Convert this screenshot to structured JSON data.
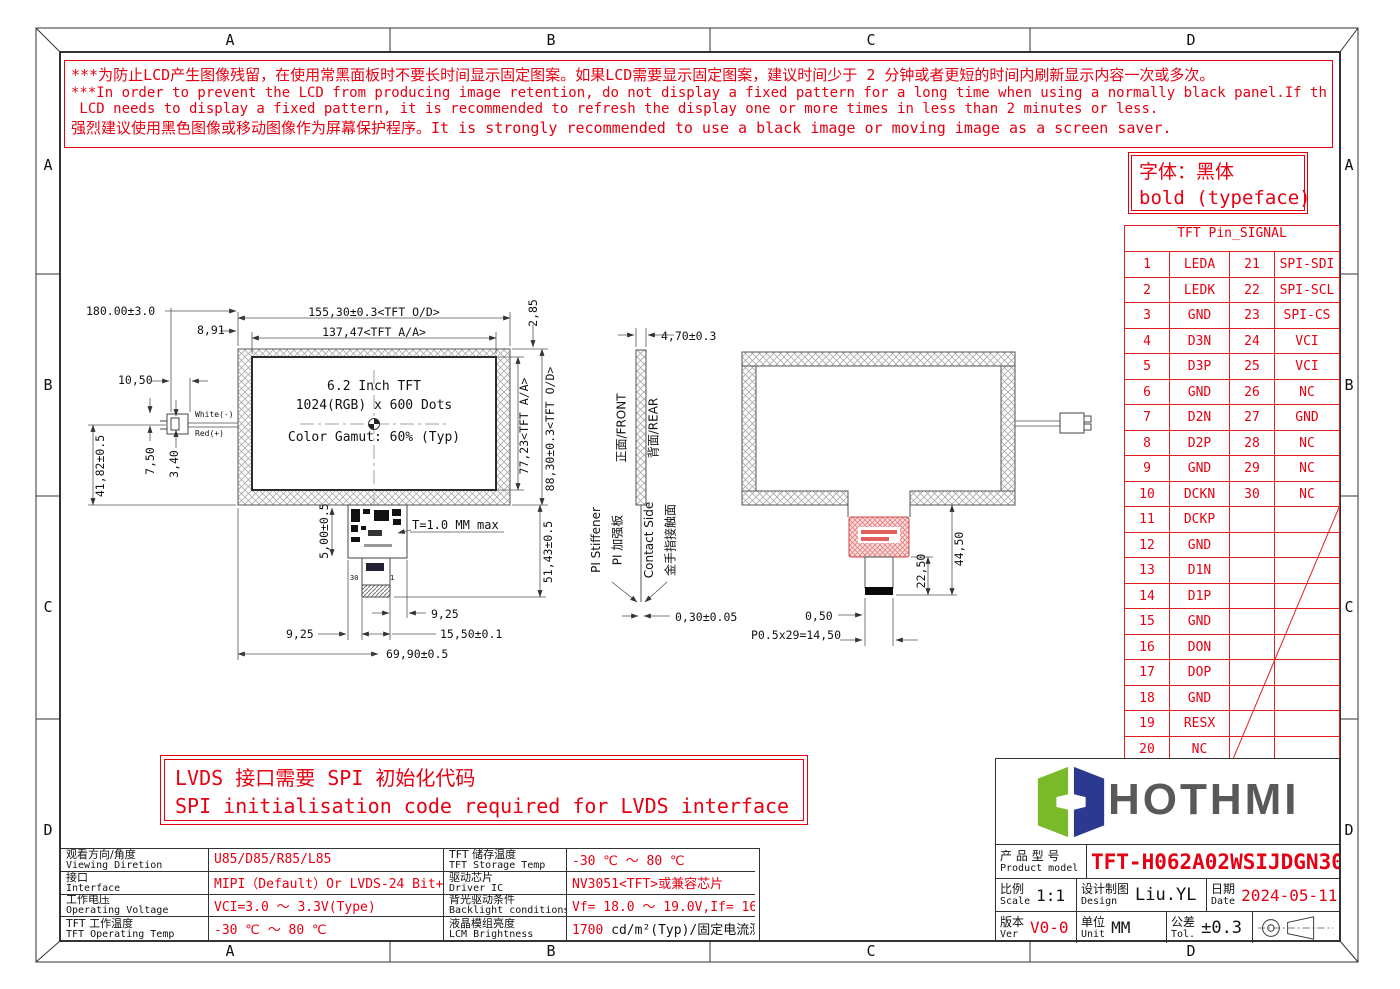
{
  "colors": {
    "red": "#e60012",
    "logo_green": "#7ab929",
    "logo_blue": "#2b3990",
    "line": "#444444"
  },
  "zones": {
    "letters": [
      "A",
      "B",
      "C",
      "D"
    ]
  },
  "warning": {
    "lines": [
      "***为防止LCD产生图像残留，在使用常黑面板时不要长时间显示固定图案。如果LCD需要显示固定图案，建议时间少于 2 分钟或者更短的时间内刷新显示内容一次或多次。",
      "***In order to prevent the LCD from producing image retention, do not display a fixed pattern for a long time when using a normally black panel.If the",
      " LCD needs to display a fixed pattern, it is recommended to refresh the display one or more times in less than 2 minutes or less.",
      "强烈建议使用黑色图像或移动图像作为屏幕保护程序。It is strongly recommended to use a black image or moving image as a screen saver."
    ]
  },
  "typeface_note": {
    "line1": "字体：黑体",
    "line2": "bold (typeface)"
  },
  "lvds_note": {
    "line1": "LVDS 接口需要 SPI 初始化代码",
    "line2": "SPI initialisation code required for LVDS interface"
  },
  "pin_table": {
    "title": "TFT Pin_SIGNAL",
    "rows": [
      {
        "p1": "1",
        "s1": "LEDA",
        "p2": "21",
        "s2": "SPI-SDI"
      },
      {
        "p1": "2",
        "s1": "LEDK",
        "p2": "22",
        "s2": "SPI-SCL"
      },
      {
        "p1": "3",
        "s1": "GND",
        "p2": "23",
        "s2": "SPI-CS"
      },
      {
        "p1": "4",
        "s1": "D3N",
        "p2": "24",
        "s2": "VCI"
      },
      {
        "p1": "5",
        "s1": "D3P",
        "p2": "25",
        "s2": "VCI"
      },
      {
        "p1": "6",
        "s1": "GND",
        "p2": "26",
        "s2": "NC"
      },
      {
        "p1": "7",
        "s1": "D2N",
        "p2": "27",
        "s2": "GND"
      },
      {
        "p1": "8",
        "s1": "D2P",
        "p2": "28",
        "s2": "NC"
      },
      {
        "p1": "9",
        "s1": "GND",
        "p2": "29",
        "s2": "NC"
      },
      {
        "p1": "10",
        "s1": "DCKN",
        "p2": "30",
        "s2": "NC"
      },
      {
        "p1": "11",
        "s1": "DCKP",
        "p2": "",
        "s2": ""
      },
      {
        "p1": "12",
        "s1": "GND",
        "p2": "",
        "s2": ""
      },
      {
        "p1": "13",
        "s1": "D1N",
        "p2": "",
        "s2": ""
      },
      {
        "p1": "14",
        "s1": "D1P",
        "p2": "",
        "s2": ""
      },
      {
        "p1": "15",
        "s1": "GND",
        "p2": "",
        "s2": ""
      },
      {
        "p1": "16",
        "s1": "DON",
        "p2": "",
        "s2": ""
      },
      {
        "p1": "17",
        "s1": "DOP",
        "p2": "",
        "s2": ""
      },
      {
        "p1": "18",
        "s1": "GND",
        "p2": "",
        "s2": ""
      },
      {
        "p1": "19",
        "s1": "RESX",
        "p2": "",
        "s2": ""
      },
      {
        "p1": "20",
        "s1": "NC",
        "p2": "",
        "s2": ""
      }
    ]
  },
  "spec_table": {
    "rows": [
      {
        "c1_cn": "观看方向/角度",
        "c1_en": "Viewing Diretion",
        "v1": "U85/D85/R85/L85",
        "c2_cn": "TFT 储存温度",
        "c2_en": "TFT Storage Temp",
        "v2": "-30 ℃ ～ 80 ℃"
      },
      {
        "c1_cn": "接口",
        "c1_en": "Interface",
        "v1": "MIPI（Default）Or LVDS-24 Bit+SPI",
        "c2_cn": "驱动芯片",
        "c2_en": "Driver IC",
        "v2": "NV3051<TFT>或兼容芯片"
      },
      {
        "c1_cn": "工作电压",
        "c1_en": "Operating Voltage",
        "v1": "VCI=3.0 ～ 3.3V(Type)",
        "c2_cn": "背光驱动条件",
        "c2_en": "Backlight conditions",
        "v2": "Vf= 18.0 ～ 19.0V,If= 160 mA"
      },
      {
        "c1_cn": "TFT 工作温度",
        "c1_en": "TFT Operating Temp",
        "v1": "-30 ℃ ～ 80 ℃",
        "c2_cn": "液晶模组亮度",
        "c2_en": "LCM Brightness",
        "v2_red": "1700",
        "v2_rest": " cd/m²(Typ)/固定电流测试"
      }
    ]
  },
  "title_block": {
    "logo_text": "HOTHMI",
    "product_label_cn": "产 品 型 号",
    "product_label_en": "Product model",
    "product_model": "TFT-H062A02WSIJDGN30",
    "scale_cn": "比例",
    "scale_en": "Scale",
    "scale_value": "1:1",
    "design_cn": "设计制图",
    "design_en": "Design",
    "design_value": "Liu.YL",
    "date_cn": "日期",
    "date_en": "Date",
    "date_value": "2024-05-11",
    "ver_cn": "版本",
    "ver_en": "Ver",
    "ver_value": "V0-0",
    "unit_cn": "单位",
    "unit_en": "Unit",
    "unit_value": "MM",
    "tol_cn": "公差",
    "tol_en": "Tol.",
    "tol_value": "±0.3"
  },
  "drawings": {
    "front": {
      "panel_line1": "6.2 Inch TFT",
      "panel_line2": "1024(RGB) x 600 Dots",
      "panel_line3": "Color Gamut: 60% (Typ)",
      "dim_total_width": "180.00±3.0",
      "dim_outline_width": "155,30±0.3<TFT O/D>",
      "dim_aa_offset": "8,91",
      "dim_aa_width": "137,47<TFT A/A>",
      "dim_top_border": "2,85",
      "dim_connector_width": "10,50",
      "wire_white": "White(-)",
      "wire_red": "Red(+)",
      "dim_wire_y": "41,82±0.5",
      "dim_connector_h": "7,50",
      "dim_wire_gap": "3,40",
      "dim_aa_height": "77,23<TFT A/A>",
      "dim_outline_height": "88,30±0.3<TFT O/D>",
      "dim_fpc_drop": "5,00±0.5",
      "thickness_note": "T=1.0 MM max",
      "dim_fpc_length": "51,43±0.5",
      "dim_fpc_edge_r": "9,25",
      "dim_fpc_edge_l": "9,25",
      "dim_tail_width": "15,50±0.1",
      "dim_fpc_offset": "69,90±0.5",
      "fpc_pin30": "30",
      "fpc_pin1": "1"
    },
    "side": {
      "dim_thickness": "4,70±0.3",
      "front_label": "正面/FRONT",
      "rear_label": "背面/REAR",
      "stiffener_en": "PI Stiffener",
      "stiffener_cn": "PI 加强板",
      "contact_en": "Contact Side",
      "contact_cn": "金手指接触面",
      "dim_fpc_thickness": "0,30±0.05"
    },
    "rear": {
      "dim_tail_total": "44,50",
      "dim_tail_len": "22,50",
      "dim_pitch_edge": "0,50",
      "dim_pitch_total": "P0.5x29=14,50"
    }
  }
}
